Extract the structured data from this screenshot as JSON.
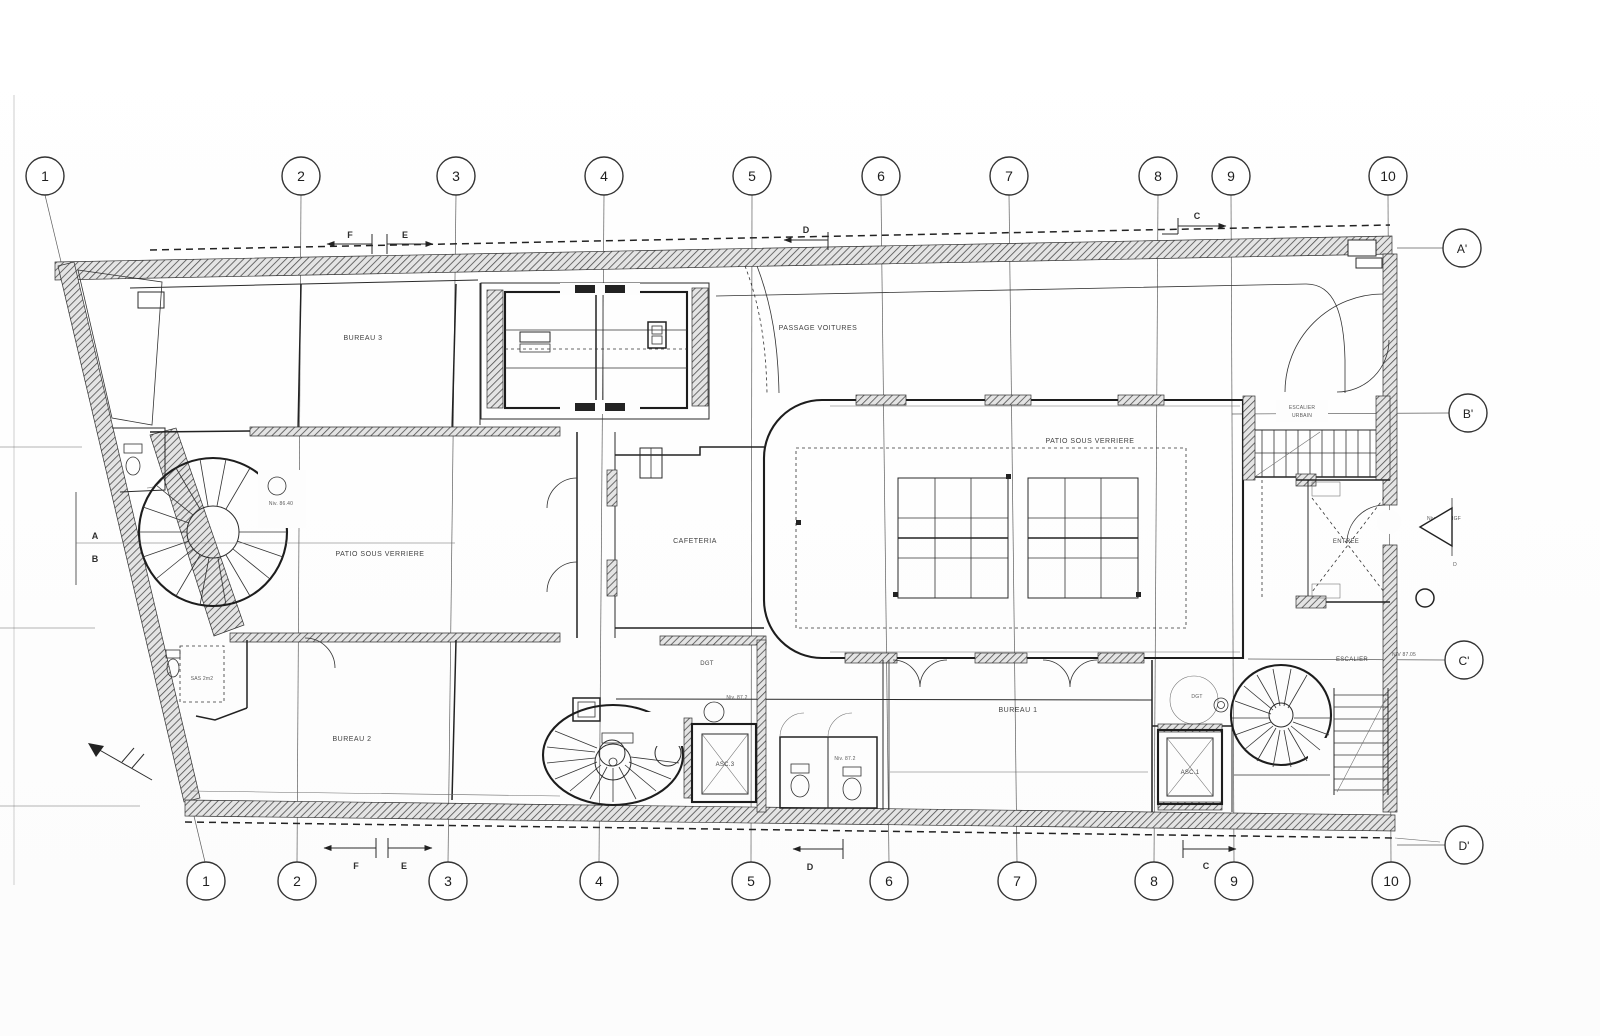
{
  "grid": {
    "top": [
      "1",
      "2",
      "3",
      "4",
      "5",
      "6",
      "7",
      "8",
      "9",
      "10"
    ],
    "bottom": [
      "1",
      "2",
      "3",
      "4",
      "5",
      "6",
      "7",
      "8",
      "9",
      "10"
    ],
    "rows": [
      "A'",
      "B'",
      "C'",
      "D'"
    ]
  },
  "rooms": {
    "bureau3": "BUREAU 3",
    "bureau2": "BUREAU 2",
    "bureau1": "BUREAU 1",
    "passage_voitures": "PASSAGE VOITURES",
    "patio_left": "PATIO SOUS VERRIERE",
    "patio_right": "PATIO SOUS VERRIERE",
    "cafeteria": "CAFETERIA",
    "entree": "ENTREE",
    "dgt_hall": "DGT",
    "dgt_room": "DGT",
    "sas": "SAS 2m2"
  },
  "elevators": {
    "asc1": "ASC.1",
    "asc3": "ASC.3"
  },
  "stairs": {
    "escalier_urbain_line1": "ESCALIER",
    "escalier_urbain_line2": "URBAIN",
    "escalier": "ESCALIER"
  },
  "sections": {
    "a": "A",
    "b": "B",
    "c": "C",
    "d": "D",
    "e": "E",
    "f": "F"
  },
  "notes": {
    "stair_tl": "Niv. 86.40",
    "asc3": "Niv. 87.2",
    "wc": "Niv. 87.2",
    "entree": "Niv. 87.0 NGF",
    "entree_d": "D",
    "escalier": "NIV 87.05"
  }
}
